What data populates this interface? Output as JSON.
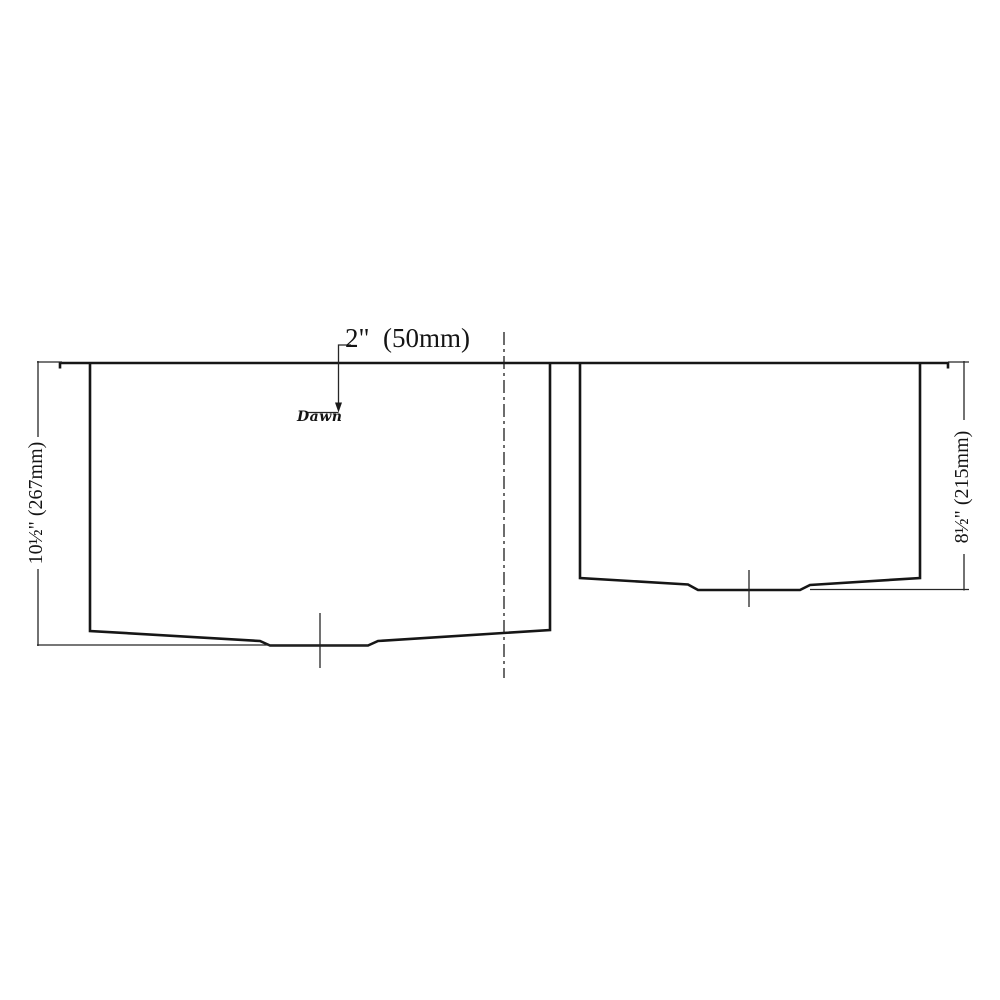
{
  "drawing": {
    "title": "double-bowl-sink-section",
    "top_dimension_label": "2\"  (50mm)",
    "left_bowl_depth_label": "10½\" (267mm)",
    "right_bowl_depth_label": "8½\" (215mm)",
    "brand_logo_text": "Dawn",
    "line_color": "#1a1a1a",
    "background_color": "#ffffff"
  }
}
